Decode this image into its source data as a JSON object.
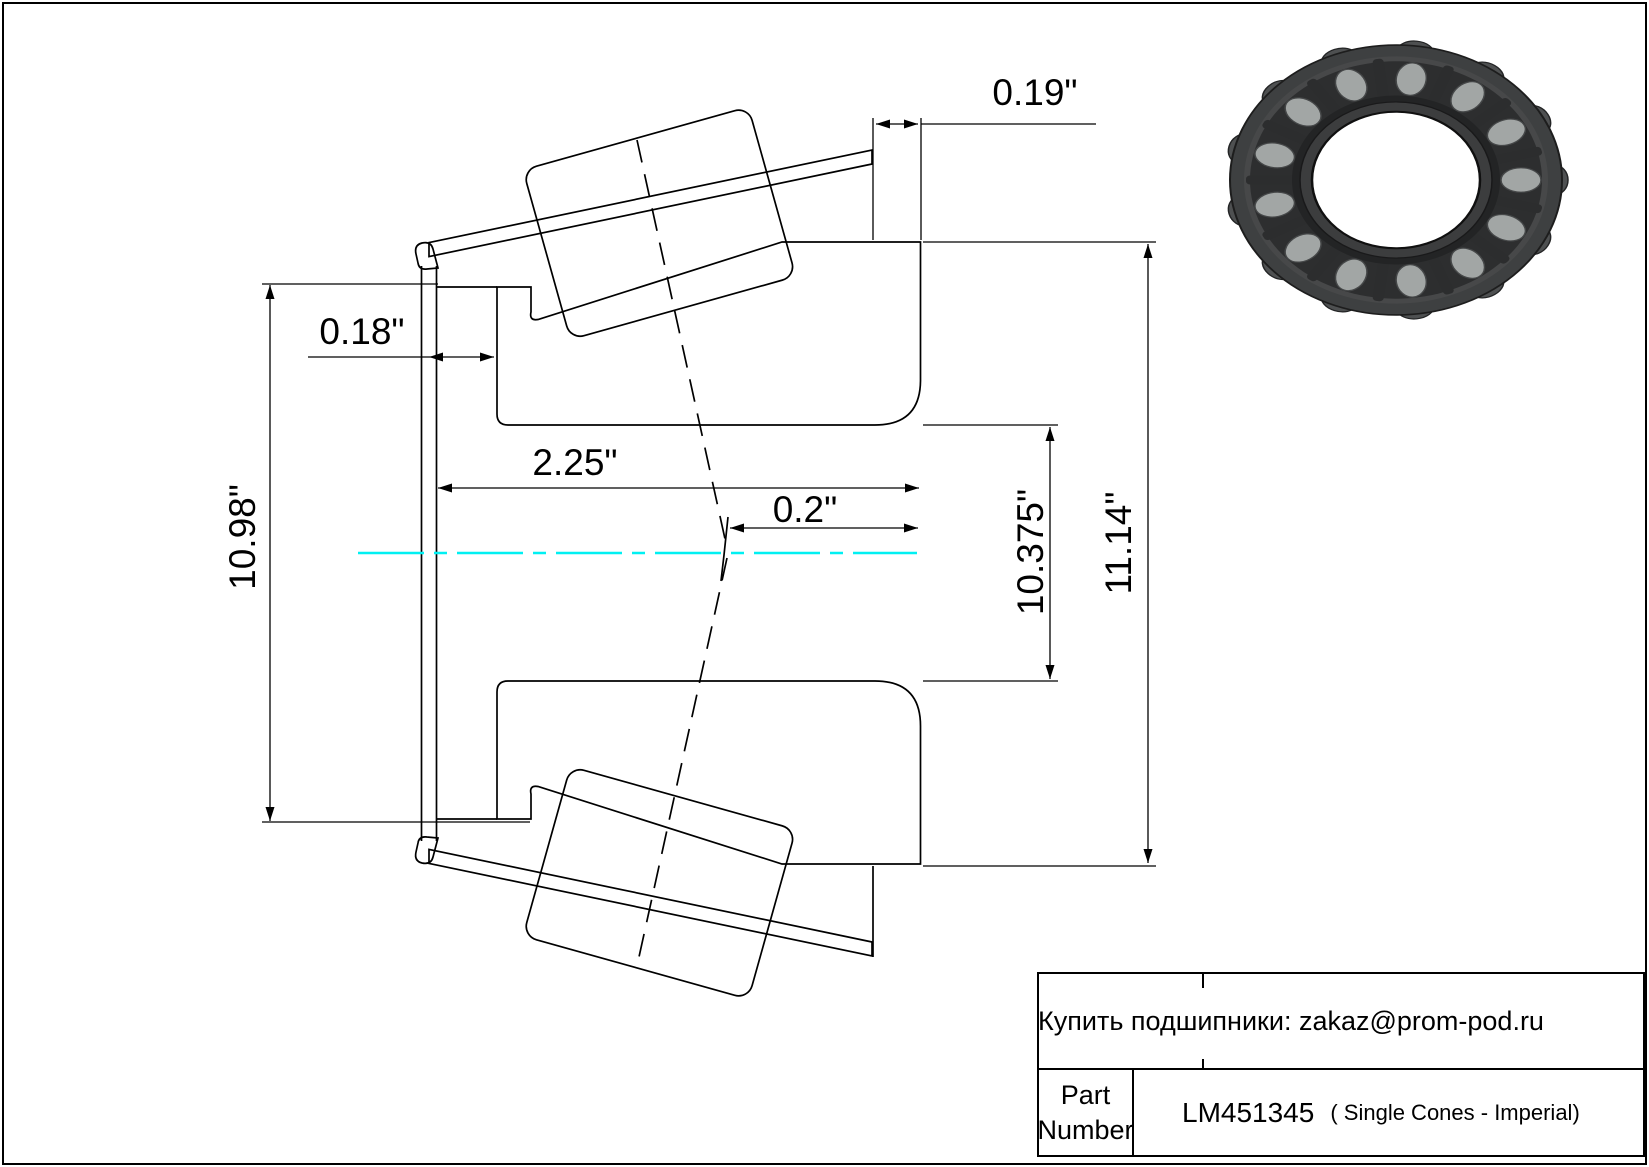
{
  "sheet": {
    "bg": "#ffffff",
    "border_color": "#000000"
  },
  "drawing": {
    "centerline_color": "#00f0f2",
    "dims": {
      "top_rib_width": "0.19\"",
      "front_gap": "0.18\"",
      "cone_width": "2.25\"",
      "apex_offset": "0.2\"",
      "cup_front_od": "10.98\"",
      "bore_diameter": "10.375\"",
      "outer_diameter": "11.14\""
    }
  },
  "title_block": {
    "contact": "Купить подшипники: zakaz@prom-pod.ru",
    "part_label_line1": "Part",
    "part_label_line2": "Number",
    "part_number": "LM451345",
    "part_note": "( Single Cones - Imperial)"
  },
  "bearing_photo": {
    "roller_count": 13
  }
}
